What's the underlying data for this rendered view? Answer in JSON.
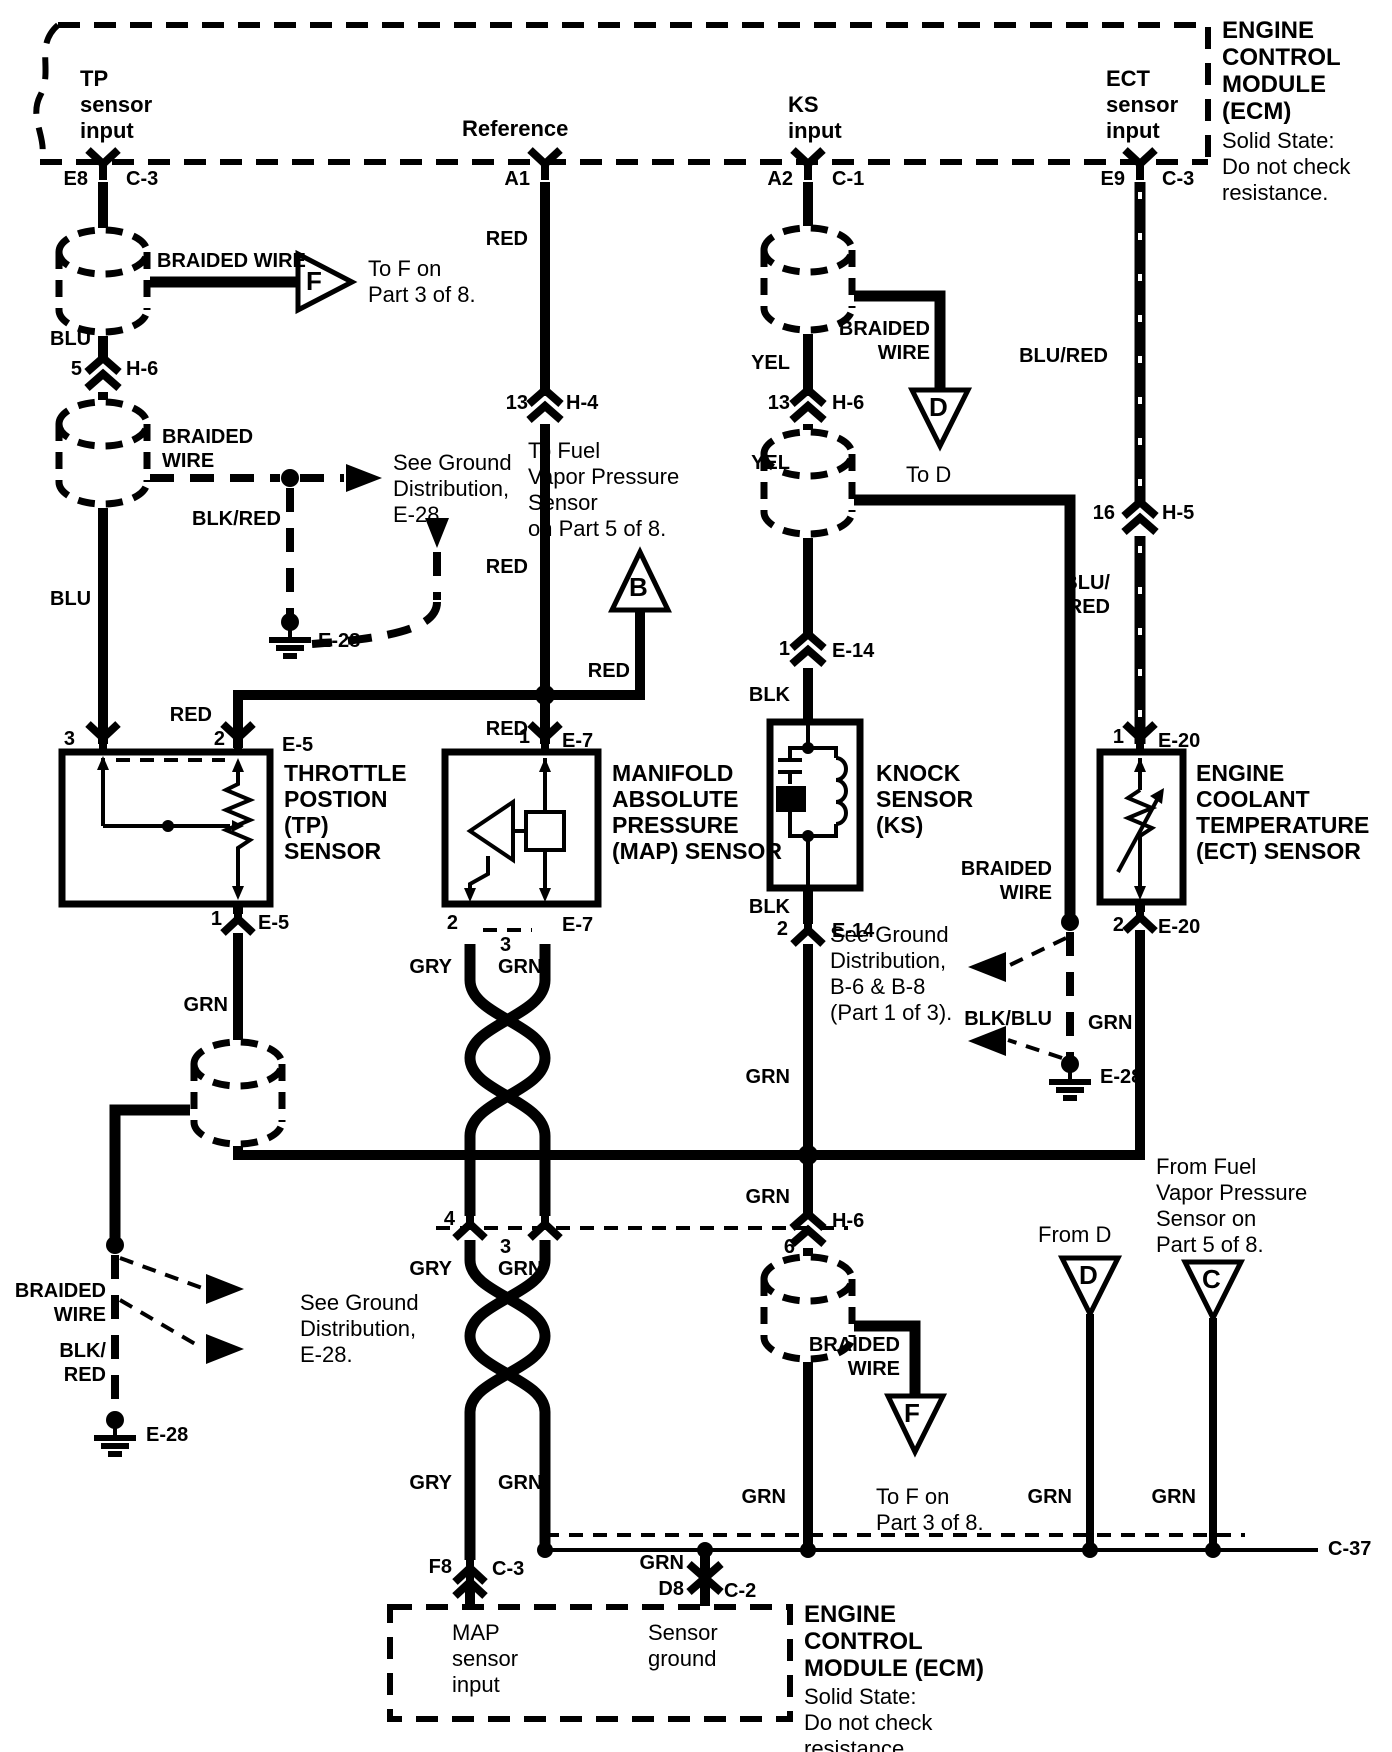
{
  "colors": {
    "ink": "#000000",
    "paper": "#ffffff"
  },
  "labels": {
    "tp_input": "TP\nsensor\ninput",
    "reference": "Reference",
    "ks_input": "KS\ninput",
    "ect_input": "ECT\nsensor\ninput",
    "ecm_title": "ENGINE\nCONTROL\nMODULE\n(ECM)",
    "ecm_note": "Solid State:\nDo not check\nresistance.",
    "e8": "E8",
    "c3_a": "C-3",
    "a1": "A1",
    "a2": "A2",
    "c1": "C-1",
    "e9": "E9",
    "c3_b": "C-3",
    "braided1": "BRAIDED WIRE",
    "f1": "F",
    "tof1": "To F on\nPart 3 of 8.",
    "blu1": "BLU",
    "n5": "5",
    "h6a": "H-6",
    "braided2": "BRAIDED\nWIRE",
    "seegnd1": "See Ground\nDistribution,\nE-28.",
    "blkred1": "BLK/RED",
    "e28a": "E-28",
    "blu2": "BLU",
    "red_a1a": "RED",
    "n13a": "13",
    "h4": "H-4",
    "red_a1b": "RED",
    "tofuel": "To Fuel\nVapor Pressure\nSensor\non  Part 5 of 8.",
    "b_tri": "B",
    "red_b": "RED",
    "red_a1c": "RED",
    "red_tp": "RED",
    "n3": "3",
    "n2": "2",
    "e5a": "E-5",
    "n1_map": "1",
    "e7a": "E-7",
    "tp_title": "THROTTLE\nPOSTION\n(TP)\nSENSOR",
    "map_title": "MANIFOLD\nABSOLUTE\nPRESSURE\n(MAP) SENSOR",
    "ks_title": "KNOCK\nSENSOR\n(KS)",
    "ect_title": "ENGINE\nCOOLANT\nTEMPERATURE\n(ECT) SENSOR",
    "yel1": "YEL",
    "n13b": "13",
    "h6b": "H-6",
    "yel2": "YEL",
    "braided3": "BRAIDED\nWIRE",
    "d1": "D",
    "tod": "To D",
    "blured1": "BLU/RED",
    "n16": "16",
    "h5": "H-5",
    "blured2": "BLU/\nRED",
    "n1_ks": "1",
    "e14a": "E-14",
    "blk1": "BLK",
    "blk2": "BLK",
    "n2_ks": "2",
    "e14b": "E-14",
    "n1_ect": "1",
    "e20a": "E-20",
    "n2_ect": "2",
    "e20b": "E-20",
    "braided4": "BRAIDED\nWIRE",
    "seegnd2": "See Ground\nDistribution,\nB-6 & B-8\n(Part 1 of 3).",
    "blkblu": "BLK/BLU",
    "grn_ect": "GRN",
    "e28b": "E-28",
    "n1_tp": "1",
    "e5b": "E-5",
    "grn_tp": "GRN",
    "braided5": "BRAIDED\nWIRE",
    "blkred2": "BLK/\nRED",
    "seegnd3": "See Ground\nDistribution,\nE-28.",
    "e28c": "E-28",
    "n2_map": "2",
    "n3_map": "3",
    "e7b": "E-7",
    "gry1": "GRY",
    "grn1": "GRN",
    "n4": "4",
    "n3b": "3",
    "h6c": "H-6",
    "n6": "6",
    "grn2": "GRN",
    "grn3": "GRN",
    "gry2": "GRY",
    "grn4": "GRN",
    "gry3": "GRY",
    "grn5": "GRN",
    "f8": "F8",
    "c3_c": "C-3",
    "grn6": "GRN",
    "tof2": "To F on\nPart 3 of 8.",
    "f2": "F",
    "braided6": "BRAIDED\nWIRE",
    "fromd": "From D",
    "d2": "D",
    "grn7": "GRN",
    "fromfuel": "From Fuel\nVapor Pressure\nSensor on\nPart 5 of 8.",
    "c_tri": "C",
    "grn8": "GRN",
    "c37": "C-37",
    "grn9": "GRN",
    "d8": "D8",
    "c2": "C-2",
    "map_input": "MAP\nsensor\ninput",
    "sensor_ground": "Sensor\nground",
    "ecm2_title": "ENGINE\nCONTROL\nMODULE (ECM)",
    "ecm2_note": "Solid State:\nDo not check\nresistance."
  }
}
